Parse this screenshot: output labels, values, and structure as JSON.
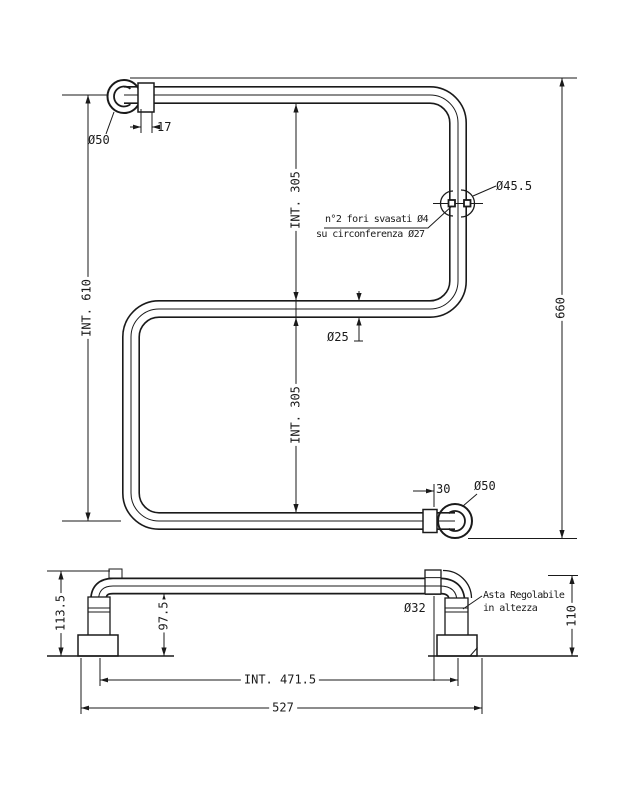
{
  "drawing": {
    "type": "technical-drawing",
    "language": "Italian",
    "line_color": "#1a1a1a",
    "background": "#ffffff",
    "front_view": {
      "dia_50_top": "Ø50",
      "dim_17": "17",
      "dim_int_610": "INT. 610",
      "dim_int_305_top": "INT. 305",
      "dim_int_305_bottom": "INT. 305",
      "dim_660": "660",
      "note_holes_line1": "n°2 fori svasati Ø4",
      "note_holes_line2": "su circonferenza Ø27",
      "dia_45_5": "Ø45.5",
      "dia_25": "Ø25",
      "dim_30": "30",
      "dia_50_bottom": "Ø50"
    },
    "side_view": {
      "dim_113_5": "113.5",
      "dim_97_5": "97.5",
      "dia_32": "Ø32",
      "note_adjustable_line1": "Asta Regolabile",
      "note_adjustable_line2": "in altezza",
      "dim_110": "110",
      "dim_int_471_5": "INT. 471.5",
      "dim_527": "527"
    }
  }
}
